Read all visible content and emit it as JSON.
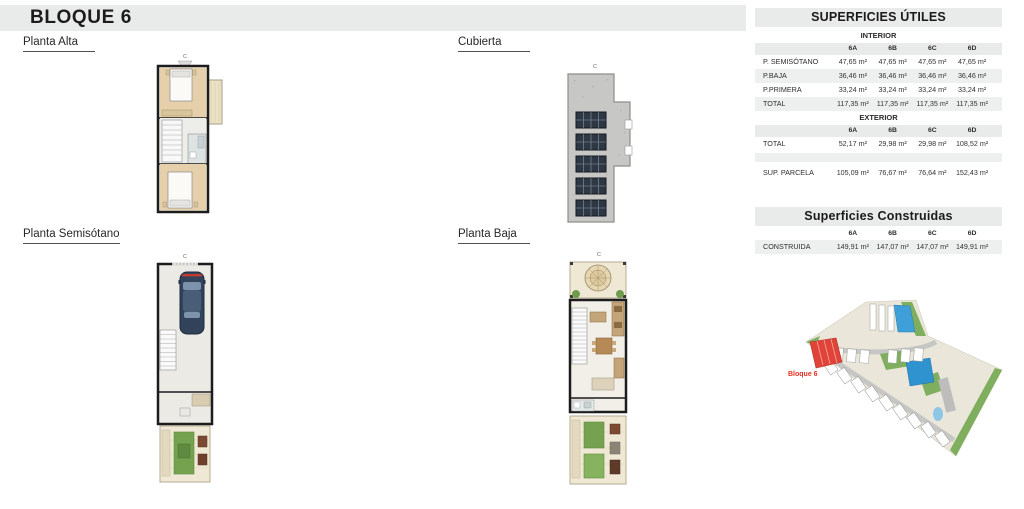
{
  "header": {
    "title": "BLOQUE 6"
  },
  "plans": {
    "planta_alta": {
      "label": "Planta Alta",
      "section_marker": "C"
    },
    "cubierta": {
      "label": "Cubierta",
      "section_marker": "C"
    },
    "planta_semisotano": {
      "label": "Planta Semisótano",
      "section_marker": "C"
    },
    "planta_baja": {
      "label": "Planta Baja",
      "section_marker": "C"
    }
  },
  "tables": {
    "utiles": {
      "title": "SUPERFICIES ÚTILES",
      "interior_label": "INTERIOR",
      "exterior_label": "EXTERIOR",
      "columns": [
        "6A",
        "6B",
        "6C",
        "6D"
      ],
      "interior_rows": [
        {
          "label": "P. SEMISÓTANO",
          "values": [
            "47,65 m²",
            "47,65 m²",
            "47,65 m²",
            "47,65 m²"
          ]
        },
        {
          "label": "P.BAJA",
          "values": [
            "36,46 m²",
            "36,46 m²",
            "36,46 m²",
            "36,46 m²"
          ]
        },
        {
          "label": "P.PRIMERA",
          "values": [
            "33,24 m²",
            "33,24 m²",
            "33,24 m²",
            "33,24 m²"
          ]
        },
        {
          "label": "TOTAL",
          "values": [
            "117,35 m²",
            "117,35 m²",
            "117,35 m²",
            "117,35 m²"
          ]
        }
      ],
      "exterior_rows": [
        {
          "label": "TOTAL",
          "values": [
            "52,17 m²",
            "29,98 m²",
            "29,98 m²",
            "108,52 m²"
          ]
        },
        {
          "label": "SUP. PARCELA",
          "values": [
            "105,09 m²",
            "76,67 m²",
            "76,64 m²",
            "152,43 m²"
          ]
        }
      ]
    },
    "construidas": {
      "title": "Superficies Construidas",
      "columns": [
        "6A",
        "6B",
        "6C",
        "6D"
      ],
      "rows": [
        {
          "label": "CONSTRUIDA",
          "values": [
            "149,91 m²",
            "147,07 m²",
            "147,07 m²",
            "149,91 m²"
          ]
        }
      ]
    }
  },
  "site_plan": {
    "highlight_label": "Bloque 6"
  },
  "colors": {
    "band_gray": "#e9ebea",
    "row_gray": "#eef0ef",
    "highlight_red": "#e04438",
    "label_red": "#e0301e",
    "pool_blue": "#3f9fd8",
    "grass_green": "#74a24e"
  }
}
